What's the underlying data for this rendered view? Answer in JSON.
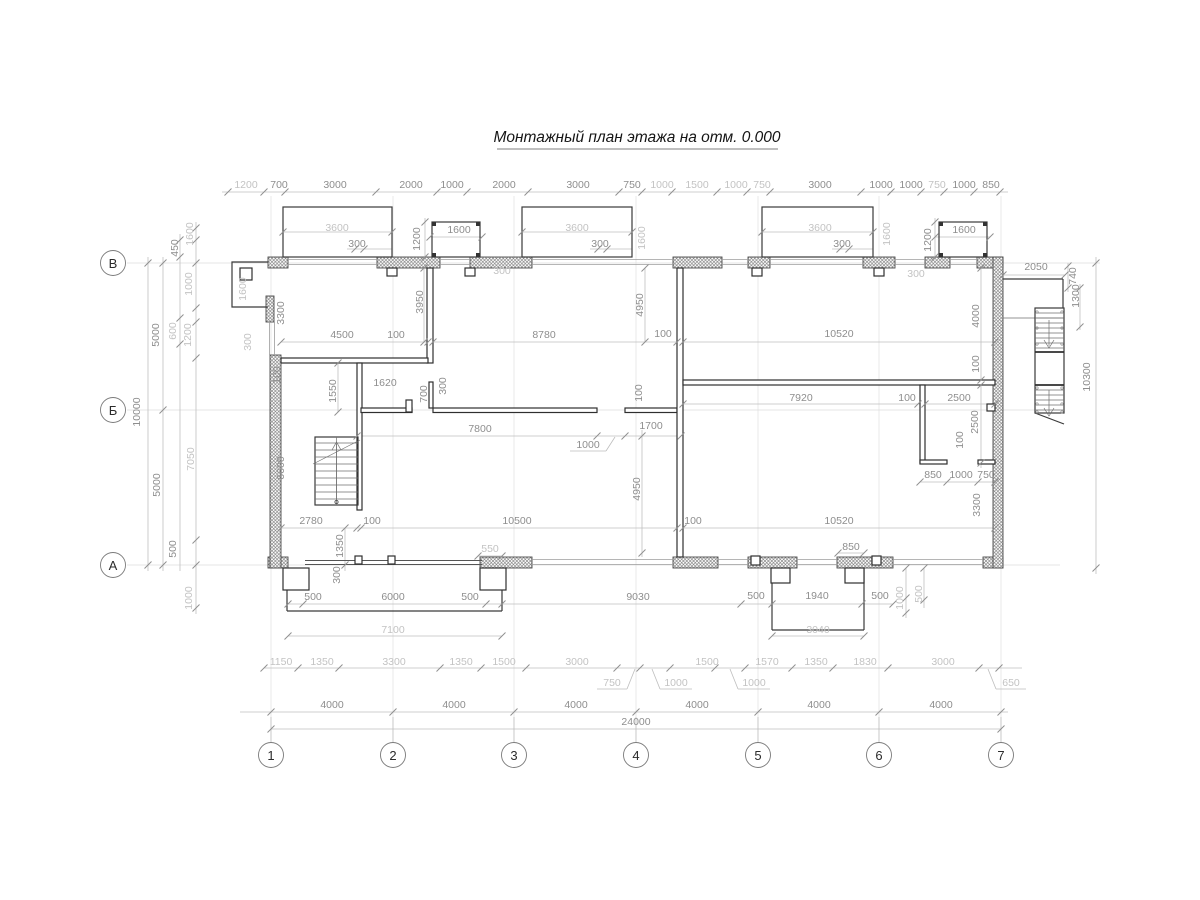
{
  "title": "Монтажный план этажа на отм. 0.000",
  "axes": {
    "cols": [
      "1",
      "2",
      "3",
      "4",
      "5",
      "6",
      "7"
    ],
    "rows": [
      "В",
      "Б",
      "А"
    ]
  },
  "dims": {
    "top": [
      "1200",
      "700",
      "3000",
      "2000",
      "1000",
      "2000",
      "3000",
      "750",
      "1000",
      "1500",
      "1000",
      "750",
      "3000",
      "1000",
      "1000",
      "750",
      "1000",
      "850"
    ],
    "upper": [
      "3600",
      "3600",
      "3600",
      "300",
      "300",
      "300",
      "1600",
      "1600",
      "1200",
      "1200",
      "1600",
      "1600",
      "300",
      "300"
    ],
    "left": [
      "1600",
      "450",
      "1000",
      "5000",
      "600",
      "1200",
      "10000",
      "7050",
      "5000",
      "500",
      "1000"
    ],
    "leftwall": [
      "1600",
      "3300",
      "300",
      "100",
      "6600"
    ],
    "mid1": [
      "4500",
      "100",
      "8780",
      "100",
      "10520",
      "3950",
      "4950",
      "4000",
      "100"
    ],
    "mid2": [
      "1550",
      "1620",
      "700",
      "300",
      "7800",
      "1000",
      "1700",
      "100"
    ],
    "mid3": [
      "7920",
      "100",
      "2500",
      "2500",
      "100",
      "850",
      "1000",
      "750"
    ],
    "mid4": [
      "2780",
      "100",
      "10500",
      "100",
      "10520",
      "4950",
      "1350",
      "300",
      "550",
      "850",
      "3300"
    ],
    "right": [
      "2050",
      "740",
      "1300",
      "10300"
    ],
    "bot": [
      "500",
      "6000",
      "500",
      "9030",
      "500",
      "1940",
      "500",
      "1000",
      "500",
      "7100",
      "3040"
    ],
    "row3": [
      "1150",
      "1350",
      "3300",
      "1350",
      "1500",
      "3000",
      "1500",
      "1570",
      "1350",
      "1830",
      "3000",
      "750",
      "1000",
      "1000",
      "650"
    ],
    "row4": [
      "4000",
      "4000",
      "4000",
      "4000",
      "4000",
      "4000"
    ],
    "total": "24000"
  }
}
